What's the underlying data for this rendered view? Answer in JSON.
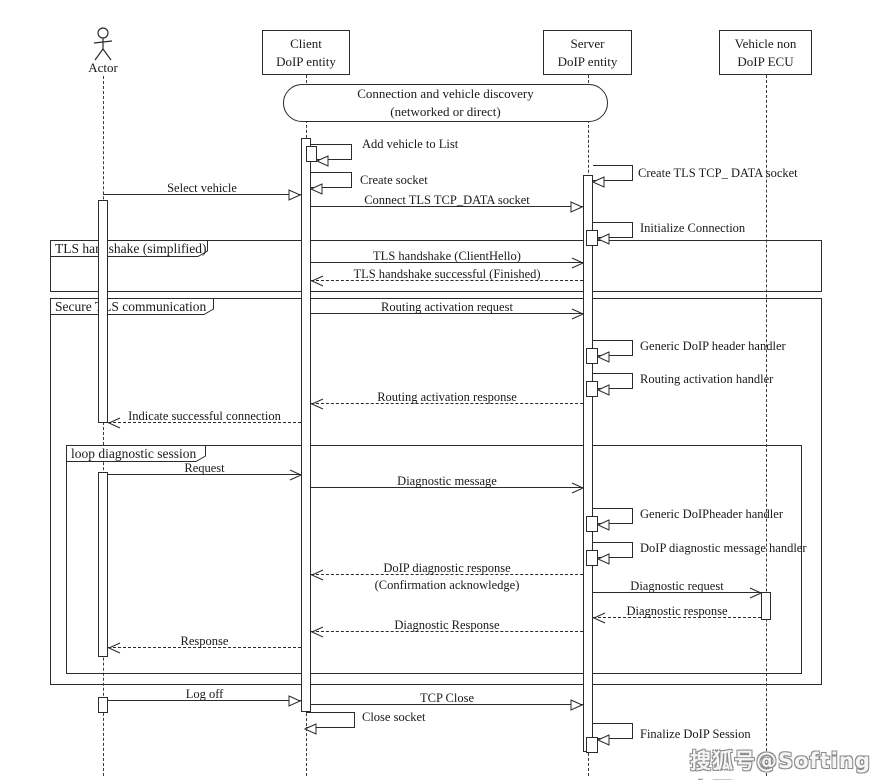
{
  "participants": {
    "actor": {
      "label": "Actor"
    },
    "client": {
      "line1": "Client",
      "line2": "DoIP entity"
    },
    "server": {
      "line1": "Server",
      "line2": "DoIP entity"
    },
    "ecu": {
      "line1": "Vehicle non",
      "line2": "DoIP ECU"
    }
  },
  "pill": {
    "line1": "Connection and vehicle discovery",
    "line2": "(networked or direct)"
  },
  "frames": {
    "tls_handshake": {
      "label": "TLS handshake (simplified)"
    },
    "secure_tls": {
      "label": "Secure TLS communication"
    },
    "loop": {
      "label": "loop diagnostic session"
    }
  },
  "messages": {
    "add_vehicle": "Add vehicle to List",
    "create_socket": "Create socket",
    "select_vehicle": "Select vehicle",
    "connect_tls": "Connect TLS TCP_DATA socket",
    "create_tls_socket": "Create TLS TCP_ DATA socket",
    "initialize_connection": "Initialize Connection",
    "tls_client_hello": "TLS handshake (ClientHello)",
    "tls_finished": "TLS handshake successful (Finished)",
    "routing_activation_request": "Routing activation request",
    "generic_doip_header_handler": "Generic DoIP header handler",
    "routing_activation_handler": "Routing activation handler",
    "routing_activation_response": "Routing activation response",
    "indicate_successful_connection": "Indicate successful connection",
    "request": "Request",
    "diagnostic_message": "Diagnostic message",
    "generic_doipheader_handler": "Generic DoIPheader handler",
    "doip_diagnostic_message_handler": "DoIP diagnostic message handler",
    "doip_diagnostic_response": "DoIP diagnostic response",
    "confirmation_acknowledge": "(Confirmation acknowledge)",
    "diagnostic_request": "Diagnostic request",
    "diagnostic_response_ecu": "Diagnostic response",
    "diagnostic_response": "Diagnostic Response",
    "response": "Response",
    "log_off": "Log off",
    "tcp_close": "TCP Close",
    "close_socket": "Close socket",
    "finalize_doip_session": "Finalize DoIP Session"
  },
  "watermark": "搜狐号@Softing中国",
  "colors": {
    "line": "#2b2b2b",
    "watermark_gray": "#8a8a8a"
  }
}
